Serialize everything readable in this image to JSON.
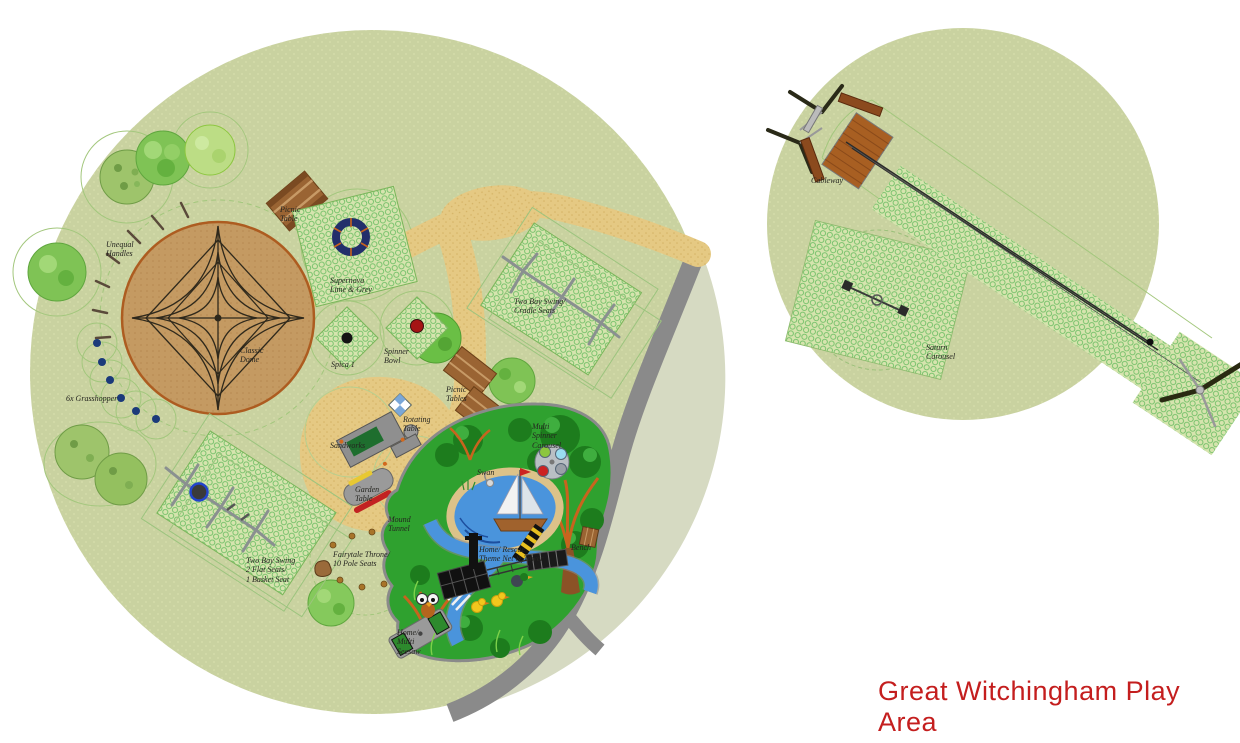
{
  "title": {
    "text": "Great Witchingham Play Area"
  },
  "colors": {
    "title_red": "#c41e1e",
    "grass_green": "#c9d2a0",
    "sand_tan": "#e5c983",
    "play_surface_green": "#2fa12f",
    "road_gray": "#8a8a8a",
    "pond_blue": "#4a94dc",
    "safety_mesh_green": "#6fbf66",
    "dome_base_tan": "#c49a62",
    "dome_border_orange": "#ad5c20",
    "supernova_navy": "#232f6b"
  },
  "labels": [
    {
      "id": "picnic-table",
      "text": "Picnic\nTable",
      "x": 280,
      "y": 205
    },
    {
      "id": "supernova",
      "text": "Supernova\nLime & Grey",
      "x": 330,
      "y": 276
    },
    {
      "id": "unequal-handles",
      "text": "Unequal\nHandles",
      "x": 106,
      "y": 240
    },
    {
      "id": "classic-dome",
      "text": "Classic\nDome",
      "x": 240,
      "y": 346
    },
    {
      "id": "spica",
      "text": "Spica 1",
      "x": 331,
      "y": 360
    },
    {
      "id": "spinner-bowl",
      "text": "Spinner\nBowl",
      "x": 384,
      "y": 347
    },
    {
      "id": "swing-cradle",
      "text": "Two Bay Swing/\nCradle Seats",
      "x": 514,
      "y": 297
    },
    {
      "id": "picnic-tables",
      "text": "Picnic\nTables",
      "x": 446,
      "y": 385
    },
    {
      "id": "rotating-table",
      "text": "Rotating\nTable",
      "x": 403,
      "y": 415
    },
    {
      "id": "sandworks",
      "text": "Sandworks",
      "x": 330,
      "y": 441
    },
    {
      "id": "garden-table",
      "text": "Garden\nTable",
      "x": 355,
      "y": 485
    },
    {
      "id": "mound-tunnel",
      "text": "Mound\nTunnel",
      "x": 388,
      "y": 515
    },
    {
      "id": "grasshopper",
      "text": "6x Grasshopper",
      "x": 66,
      "y": 394
    },
    {
      "id": "swing-basket",
      "text": "Two Bay Swing\n2  Flat Seats/\n1 Basket Seat",
      "x": 246,
      "y": 556
    },
    {
      "id": "fairytale-throne",
      "text": "Fairytale Throne/\n10 Pole Seats",
      "x": 333,
      "y": 550
    },
    {
      "id": "multi-spinner",
      "text": "Multi\nSpinner\nCarousel",
      "x": 532,
      "y": 422
    },
    {
      "id": "swan",
      "text": "Swan",
      "x": 477,
      "y": 468
    },
    {
      "id": "rescue-tower",
      "text": "Home/ Rescue\nTheme Net & Tower",
      "x": 479,
      "y": 545
    },
    {
      "id": "bench",
      "text": "Bench",
      "x": 571,
      "y": 543
    },
    {
      "id": "seesaw",
      "text": "Home/\nMulti\nSeesaw",
      "x": 397,
      "y": 628
    },
    {
      "id": "cableway",
      "text": "Cableway",
      "x": 811,
      "y": 176
    },
    {
      "id": "saturn-carousel",
      "text": "Saturn\nCarousel",
      "x": 926,
      "y": 343
    }
  ]
}
